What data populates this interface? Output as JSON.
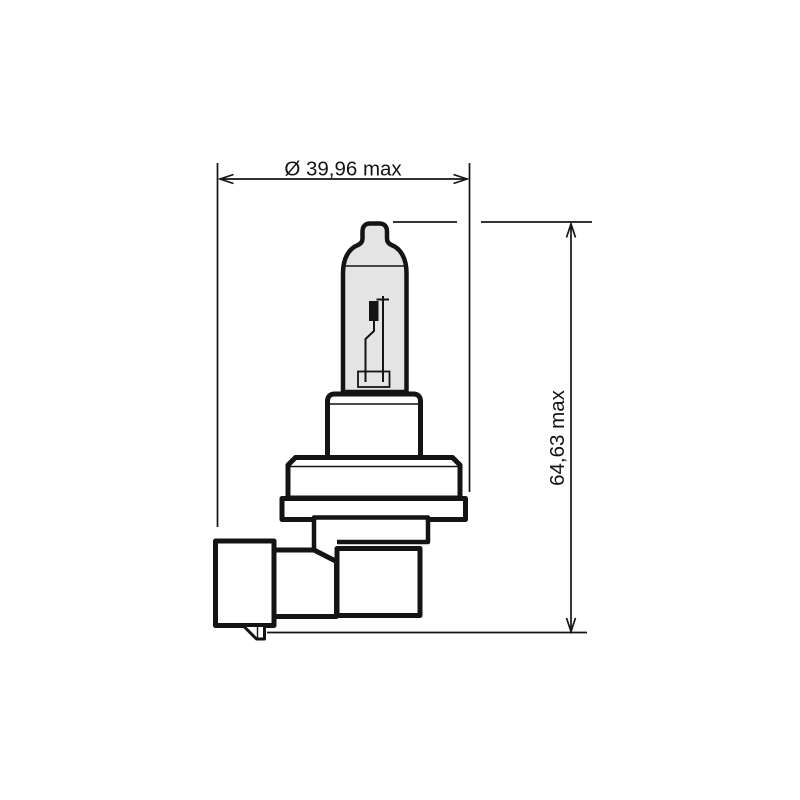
{
  "drawing": {
    "labels": {
      "diameter": "Ø 39,96 max",
      "height": "64,63 max"
    },
    "colors": {
      "line": "#141414",
      "glass_fill": "#e4e4e4",
      "background": "#ffffff"
    }
  }
}
